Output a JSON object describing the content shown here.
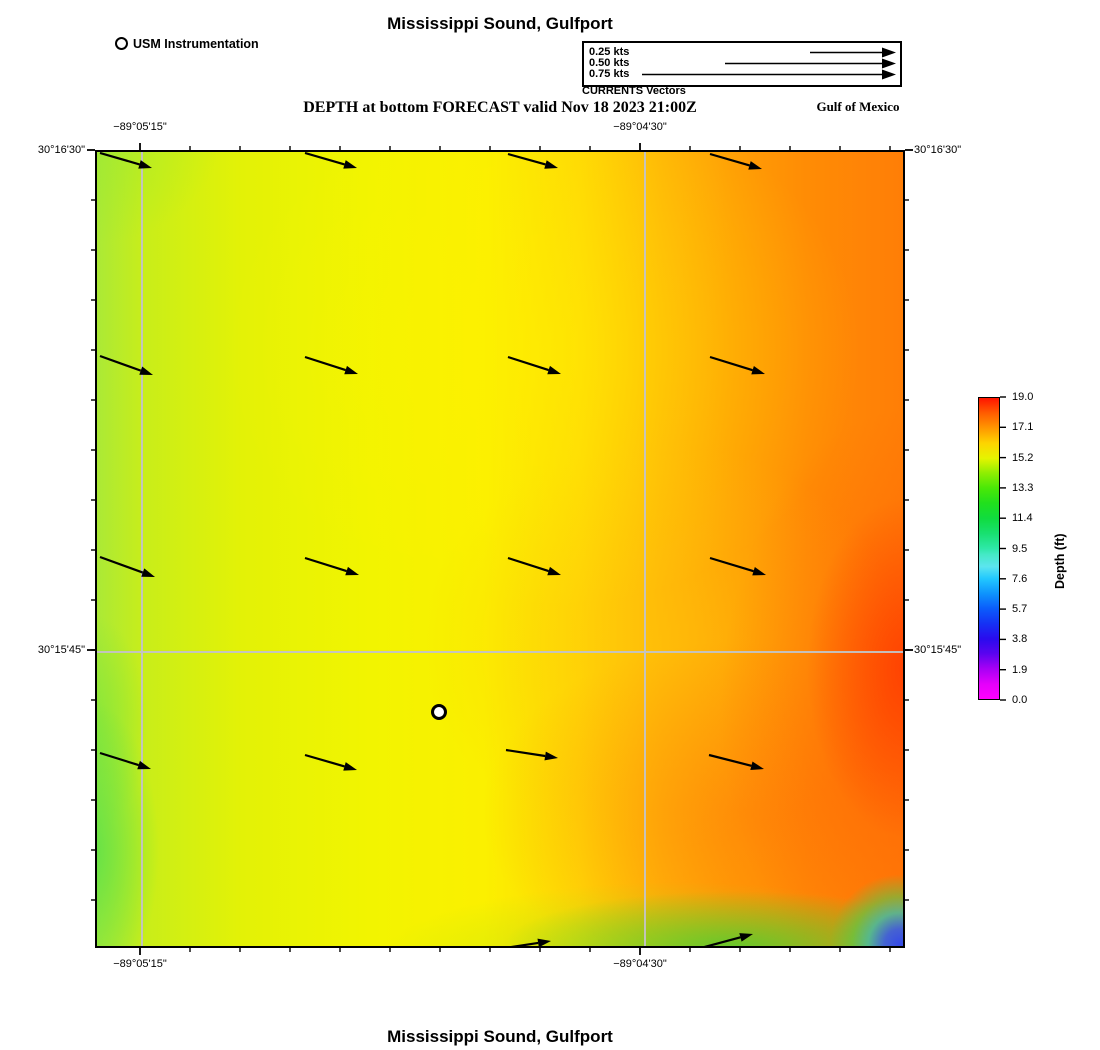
{
  "page": {
    "title_top": "Mississippi Sound, Gulfport",
    "title_bottom": "Mississippi Sound, Gulfport",
    "forecast_heading": "DEPTH at bottom FORECAST valid Nov 18 2023 21:00Z",
    "region_label": "Gulf of Mexico"
  },
  "station_legend": {
    "label": "USM Instrumentation"
  },
  "currents_legend": {
    "caption": "CURRENTS Vectors",
    "entries": [
      {
        "label": "0.25 kts",
        "arrow_len_px": 86
      },
      {
        "label": "0.50 kts",
        "arrow_len_px": 171
      },
      {
        "label": "0.75 kts",
        "arrow_len_px": 254
      }
    ]
  },
  "colors": {
    "arrow": "#000000",
    "grid": "#c3c3c3",
    "frame": "#000000",
    "station_fill": "#ffffff",
    "map_left_green": "#abe936",
    "map_mid_yellow": "#f8f400",
    "map_right_orange": "#ff7e06",
    "map_deep_red": "#ff3700",
    "map_corner_blue": "#2d46f3"
  },
  "chart_data": {
    "type": "heatmap",
    "title": "Mississippi Sound, Gulfport",
    "subtitle": "DEPTH at bottom FORECAST valid Nov 18 2023 21:00Z",
    "legend_position": "top",
    "grid": true,
    "x_axis": {
      "ticks": [
        {
          "label": "−89°05'15\"",
          "px": 140
        },
        {
          "label": "−89°04'30\"",
          "px": 640
        }
      ],
      "minor_tick_start_px": 140,
      "minor_tick_end_px": 890,
      "minor_tick_step_px": 50
    },
    "y_axis": {
      "ticks": [
        {
          "label": "30°16'30\"",
          "px": 150
        },
        {
          "label": "30°15'45\"",
          "px": 650
        }
      ],
      "minor_tick_start_px": 200,
      "minor_tick_end_px": 900,
      "minor_tick_step_px": 50
    },
    "colorbar": {
      "label": "Depth (ft)",
      "tick_labels": [
        "19.0",
        "17.1",
        "15.2",
        "13.3",
        "11.4",
        "9.5",
        "7.6",
        "5.7",
        "3.8",
        "1.9",
        "0.0"
      ],
      "min": 0.0,
      "max": 19.0,
      "stops": [
        [
          0.0,
          "#ff00ff"
        ],
        [
          0.05,
          "#e400fb"
        ],
        [
          0.1,
          "#a800f5"
        ],
        [
          0.15,
          "#5b04ef"
        ],
        [
          0.2,
          "#2a0bee"
        ],
        [
          0.25,
          "#1531f4"
        ],
        [
          0.3,
          "#0b5cfb"
        ],
        [
          0.35,
          "#0e93fd"
        ],
        [
          0.4,
          "#22c8fe"
        ],
        [
          0.44,
          "#5ce5ef"
        ],
        [
          0.48,
          "#45e9c6"
        ],
        [
          0.5,
          "#2ee8a8"
        ],
        [
          0.55,
          "#18e070"
        ],
        [
          0.6,
          "#10dc3f"
        ],
        [
          0.65,
          "#20e01d"
        ],
        [
          0.7,
          "#49e807"
        ],
        [
          0.75,
          "#8eee02"
        ],
        [
          0.8,
          "#e6f400"
        ],
        [
          0.85,
          "#fdd400"
        ],
        [
          0.9,
          "#ff9700"
        ],
        [
          0.95,
          "#ff5c00"
        ],
        [
          1.0,
          "#ff1400"
        ]
      ]
    },
    "station": {
      "name": "USM Instrumentation",
      "x_px": 437,
      "y_px": 710
    },
    "current_vectors_px": [
      [
        100,
        153,
        152,
        168
      ],
      [
        305,
        153,
        357,
        168
      ],
      [
        508,
        154,
        558,
        168
      ],
      [
        710,
        154,
        762,
        169
      ],
      [
        100,
        356,
        153,
        375
      ],
      [
        305,
        357,
        358,
        374
      ],
      [
        508,
        357,
        561,
        374
      ],
      [
        710,
        357,
        765,
        374
      ],
      [
        100,
        557,
        155,
        577
      ],
      [
        305,
        558,
        359,
        575
      ],
      [
        508,
        558,
        561,
        575
      ],
      [
        710,
        558,
        766,
        575
      ],
      [
        100,
        753,
        151,
        769
      ],
      [
        305,
        755,
        357,
        770
      ],
      [
        506,
        750,
        558,
        758
      ],
      [
        709,
        755,
        764,
        769
      ],
      [
        505,
        948,
        551,
        941
      ],
      [
        697,
        949,
        753,
        934
      ]
    ],
    "gridlines_px": {
      "vertical_x": [
        140,
        643
      ],
      "horizontal_y": [
        650
      ]
    }
  }
}
